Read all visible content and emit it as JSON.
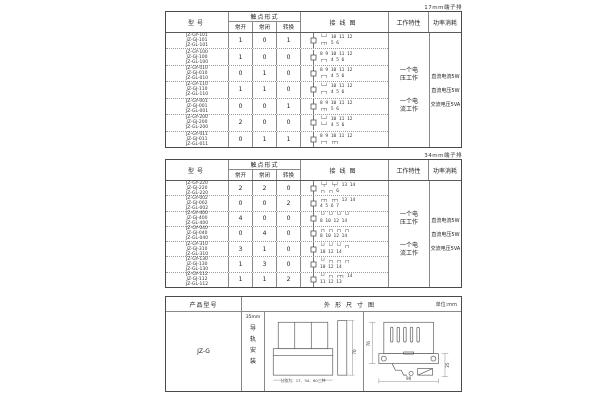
{
  "colors": {
    "border": "#4a4a4a",
    "grid": "#8a8a8a",
    "text": "#222222",
    "background": "#ffffff"
  },
  "table1": {
    "corner_label": "17mm端子排",
    "headers": {
      "model": "型号",
      "contact": "触点形式",
      "no": "常开",
      "nc": "常闭",
      "co": "转换",
      "wiring": "接线图",
      "work": "工作特性",
      "power": "功率消耗"
    },
    "rows": [
      {
        "models": "JZ-GY-101\nJZ-GJ-101\nJZ-GL-101",
        "no": "1",
        "nc": "0",
        "co": "1",
        "dtop": "└─┘ 10 11 12",
        "dbot": "┌┬┐ 5 6"
      },
      {
        "models": "JZ-GY-100\nJZ-GJ-100\nJZ-GL-100",
        "no": "1",
        "nc": "0",
        "co": "0",
        "dtop": "8 9 10 11 12",
        "dbot": "┌─┐ 4 5 6"
      },
      {
        "models": "JZ-GY-010\nJZ-GJ-010\nJZ-GL-010",
        "no": "0",
        "nc": "1",
        "co": "0",
        "dtop": "8 9 10 11 12",
        "dbot": "┌─┐ 4 5 6"
      },
      {
        "models": "JZ-GY-110\nJZ-GJ-110\nJZ-GL-110",
        "no": "1",
        "nc": "1",
        "co": "0",
        "dtop": "└─┘ 10 11 12",
        "dbot": "┌─┐ 4 5 6"
      },
      {
        "models": "JZ-GY-001\nJZ-GJ-001\nJZ-GL-001",
        "no": "0",
        "nc": "0",
        "co": "1",
        "dtop": "8 9 10 11 12",
        "dbot": "┌┬┐ 5 6"
      },
      {
        "models": "JZ-GY-200\nJZ-GJ-200\nJZ-GL-200",
        "no": "2",
        "nc": "0",
        "co": "0",
        "dtop": "└─┘ 10 11 12",
        "dbot": "└─┘ 4 5 6"
      },
      {
        "models": "JZ-GY-011\nJZ-GJ-011\nJZ-GL-011",
        "no": "0",
        "nc": "1",
        "co": "1",
        "dtop": "8 9 10 11 12",
        "dbot": "┌─┐ ┌┬┐"
      }
    ],
    "work_labels": [
      "一个电压工作",
      "一个电流工作"
    ],
    "power_lines": [
      "直流电流5W",
      "直流电压5W",
      "交流电压5VA"
    ]
  },
  "table2": {
    "corner_label": "34mm端子排",
    "headers": {
      "model": "型号",
      "contact": "触点形式",
      "no": "常开",
      "nc": "常闭",
      "co": "转换",
      "wiring": "接线图",
      "work": "工作特性",
      "power": "功率消耗"
    },
    "rows": [
      {
        "models": "JZ-GY-220\nJZ-GJ-220\nJZ-GL-220",
        "no": "2",
        "nc": "2",
        "co": "0",
        "dtop": "└┬┘ └┬┘ 13 14",
        "dbot": "┌┐ ┌┐ 6"
      },
      {
        "models": "JZ-GY-002\nJZ-GJ-002\nJZ-GL-002",
        "no": "0",
        "nc": "0",
        "co": "2",
        "dtop": "┌┬┐ ┌┬┐ 13 14",
        "dbot": "4 5 6 7"
      },
      {
        "models": "JZ-GY-400\nJZ-GJ-400\nJZ-GL-400",
        "no": "4",
        "nc": "0",
        "co": "0",
        "dtop": "└┘ └┘ └┘ └┘",
        "dbot": "8 10 12 14"
      },
      {
        "models": "JZ-GY-040\nJZ-GJ-040\nJZ-GL-040",
        "no": "0",
        "nc": "4",
        "co": "0",
        "dtop": "┌┐ ┌┐ ┌┐ ┌┐",
        "dbot": "8 10 12 14"
      },
      {
        "models": "JZ-GY-310\nJZ-GJ-310\nJZ-GL-310",
        "no": "3",
        "nc": "1",
        "co": "0",
        "dtop": "└┘ └┘ └┘ ┌┐",
        "dbot": "10 12 14"
      },
      {
        "models": "JZ-GY-130\nJZ-GJ-130\nJZ-GL-130",
        "no": "1",
        "nc": "3",
        "co": "0",
        "dtop": "└┘ ┌┐ ┌┐ ┌┐",
        "dbot": "10 12 14"
      },
      {
        "models": "JZ-GY-112\nJZ-GJ-112\nJZ-GL-112",
        "no": "1",
        "nc": "1",
        "co": "2",
        "dtop": "└┘ ┌┐ ┌┬┐ 14",
        "dbot": "11 12 13"
      }
    ],
    "work_labels": [
      "一个电压工作",
      "一个电流工作"
    ],
    "power_lines": [
      "直流电流5W",
      "直流电压5W",
      "交流电压5VA"
    ]
  },
  "bottom": {
    "header_product": "产品型号",
    "header_outline": "外形尺寸图",
    "header_unit": "单位:mm",
    "model": "JZ-G",
    "mount_size": "35mm",
    "mount_text": "导\n轨\n安\n装",
    "caption": "分别为：17、34、60三种",
    "dims": {
      "front_height": "70",
      "side_height": "76",
      "side_width": "90",
      "rail_width": "35"
    }
  }
}
